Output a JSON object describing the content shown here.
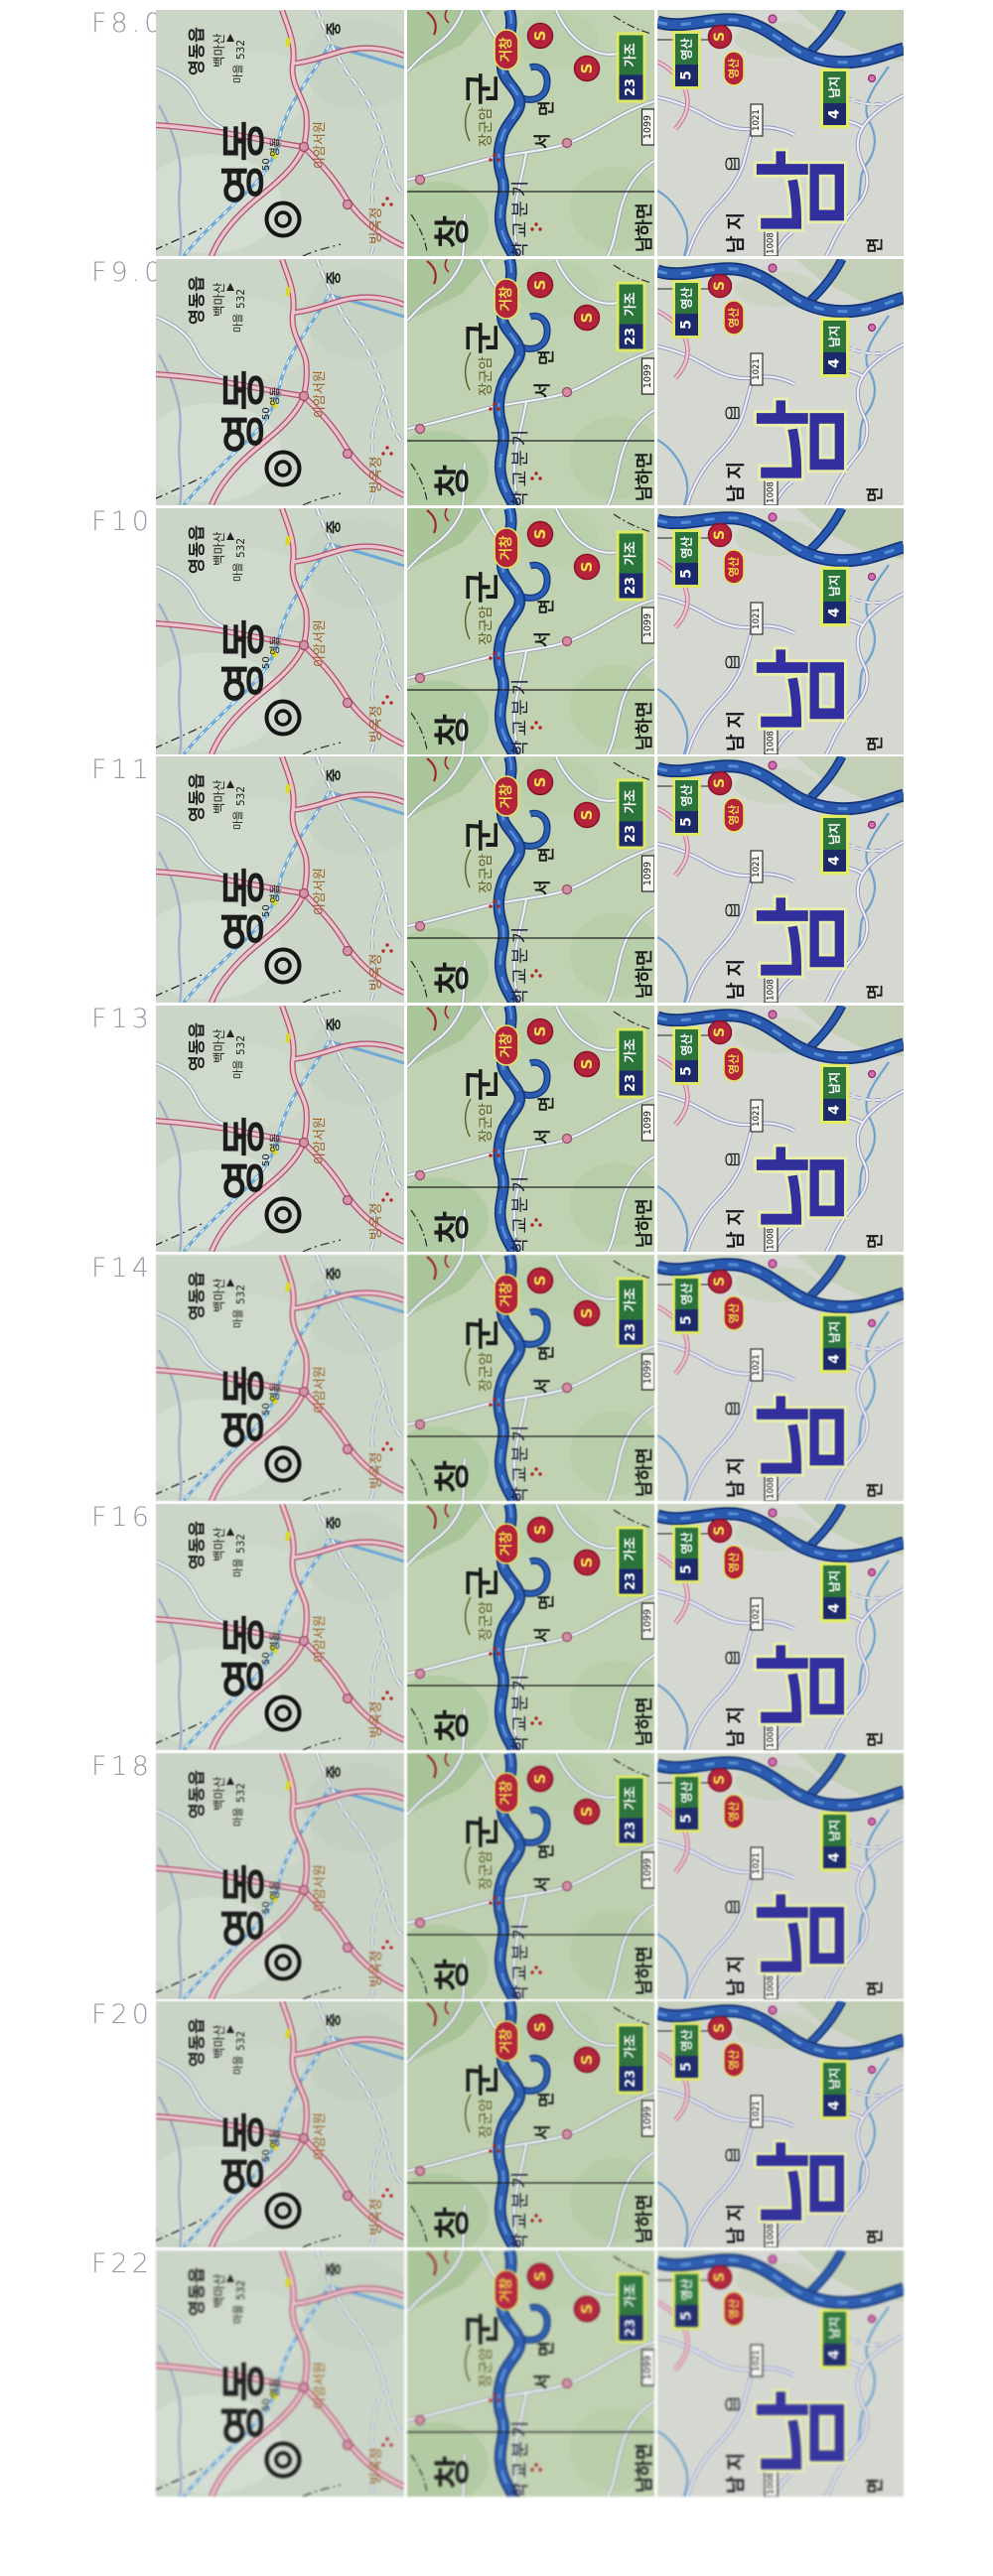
{
  "comparison": {
    "rows": [
      {
        "aperture": "F8.0"
      },
      {
        "aperture": "F9.0"
      },
      {
        "aperture": "F10"
      },
      {
        "aperture": "F11"
      },
      {
        "aperture": "F13"
      },
      {
        "aperture": "F14"
      },
      {
        "aperture": "F16"
      },
      {
        "aperture": "F18"
      },
      {
        "aperture": "F20"
      },
      {
        "aperture": "F22"
      }
    ]
  },
  "map_left": {
    "town_big": "영동",
    "town_small": "영동",
    "road_number": "50",
    "eup_label": "영동읍",
    "mountain": "백마산",
    "elevation": "532",
    "village": "마을",
    "jung_char": "중",
    "seowon": "이암서원",
    "pavilion": "빙옥정"
  },
  "map_middle": {
    "gun_char": "군",
    "chang_char": "창",
    "rock": "장군암",
    "myeon_char": "면",
    "seo_char": "서",
    "column_text": "학교분기",
    "namha_myeon": "남하면",
    "badge_geochang": "거창",
    "badge_s1": "S",
    "badge_s2": "S",
    "badge_gajo": "가조",
    "badge_23": "23",
    "route_1099": "1099"
  },
  "map_right": {
    "big_town": "남",
    "small_town": "남지",
    "myeon_char": "면",
    "badge_yeongsan_green": "영산",
    "badge_5": "5",
    "badge_s": "S",
    "badge_yeongsan_red": "영산",
    "badge_namji": "남지",
    "badge_4": "4",
    "route_1021": "1021",
    "route_1008": "1008"
  },
  "colors": {
    "badge_red": "#b3233b",
    "badge_green": "#2c743c",
    "badge_navy": "#1c2a6c",
    "badge_yellow_text": "#f2e14e",
    "river_blue": "#2c5fb2",
    "road_pink": "#b25570",
    "road_purple": "#8f93c2",
    "big_town_navy": "#32309c",
    "aperture_label_gray": "#9a9a9a"
  }
}
